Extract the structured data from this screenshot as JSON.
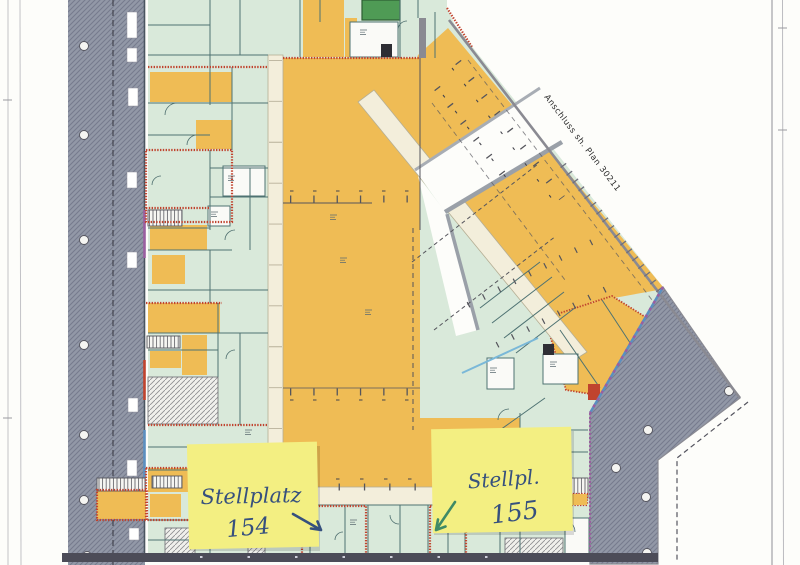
{
  "plan": {
    "connection_label": "Anschluss sh. Plan 30211"
  },
  "sticky_notes": [
    {
      "line1": "Stellplatz",
      "line2": "154"
    },
    {
      "line1": "Stellpl.",
      "line2": "155"
    }
  ],
  "colors": {
    "page": "#fdfdfa",
    "parking_orange": "#efbc55",
    "room_mint": "#d9e9da",
    "corridor_cream": "#f3eedb",
    "band_gray": "#9298a7",
    "band_line": "#767b8e",
    "wall_teal": "#4e7272",
    "wall_red": "#c0432e",
    "edge_blue": "#5b8fc0",
    "edge_purple": "#9a5fa0",
    "accent_green": "#4f9b55",
    "note_yellow": "#f3ef82",
    "ink_blue": "#36507e",
    "arrow_green": "#3f8a66"
  }
}
